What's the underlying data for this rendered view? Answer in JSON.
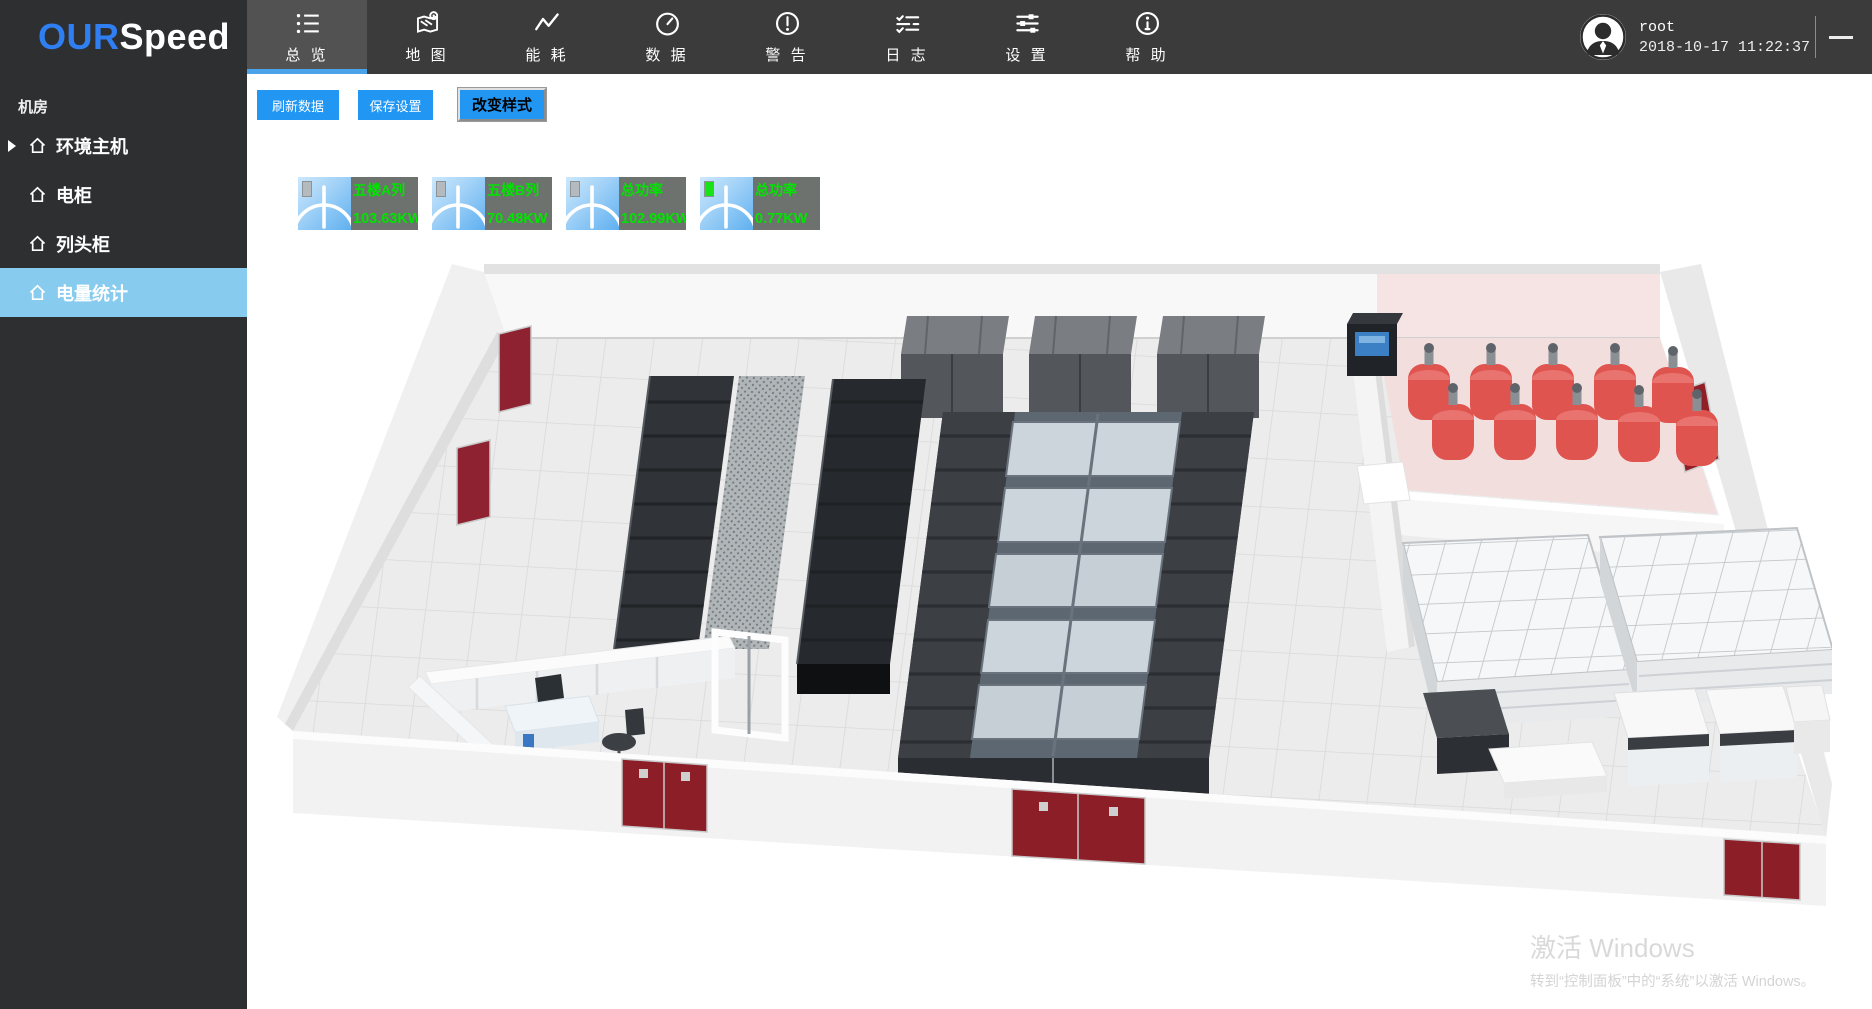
{
  "colors": {
    "accent_blue": "#2196f3",
    "tab_underline": "#4aa2e9",
    "sidebar_active_bg": "#87cbef",
    "logo_blue": "#2f7ff2",
    "meter_green": "#00e400",
    "meter_bg": "#6e726e",
    "topbar_bg": "#3b3b3c",
    "sidebar_bg": "#2e2f31"
  },
  "topbar": {
    "logo": {
      "part1": "OUR",
      "part2": "Speed"
    },
    "tabs": [
      {
        "label": "总 览",
        "icon": "list-icon"
      },
      {
        "label": "地 图",
        "icon": "map-icon"
      },
      {
        "label": "能 耗",
        "icon": "energy-icon"
      },
      {
        "label": "数 据",
        "icon": "gauge-icon"
      },
      {
        "label": "警 告",
        "icon": "alert-icon"
      },
      {
        "label": "日 志",
        "icon": "log-icon"
      },
      {
        "label": "设 置",
        "icon": "settings-icon"
      },
      {
        "label": "帮 助",
        "icon": "help-icon"
      }
    ],
    "user": {
      "name": "root",
      "datetime": "2018-10-17 11:22:37"
    }
  },
  "sidebar": {
    "section_title": "机房",
    "items": [
      {
        "label": "环境主机"
      },
      {
        "label": "电柜"
      },
      {
        "label": "列头柜"
      },
      {
        "label": "电量统计"
      }
    ]
  },
  "toolbar": {
    "buttons": [
      {
        "label": "刷新数据"
      },
      {
        "label": "保存设置"
      },
      {
        "label": "改变样式"
      }
    ]
  },
  "meters": [
    {
      "label": "五楼A列",
      "value": "103.63KW",
      "led_color": "#b4babe"
    },
    {
      "label": "五楼B列",
      "value": "70.48KW",
      "led_color": "#b4babe"
    },
    {
      "label": "总功率",
      "value": "102.99KW",
      "led_color": "#b4babe"
    },
    {
      "label": "总功率",
      "value": "0.77KW",
      "led_color": "#17e317"
    }
  ],
  "watermark": {
    "title": "激活 Windows",
    "subtitle": "转到“控制面板”中的“系统”以激活 Windows。"
  }
}
